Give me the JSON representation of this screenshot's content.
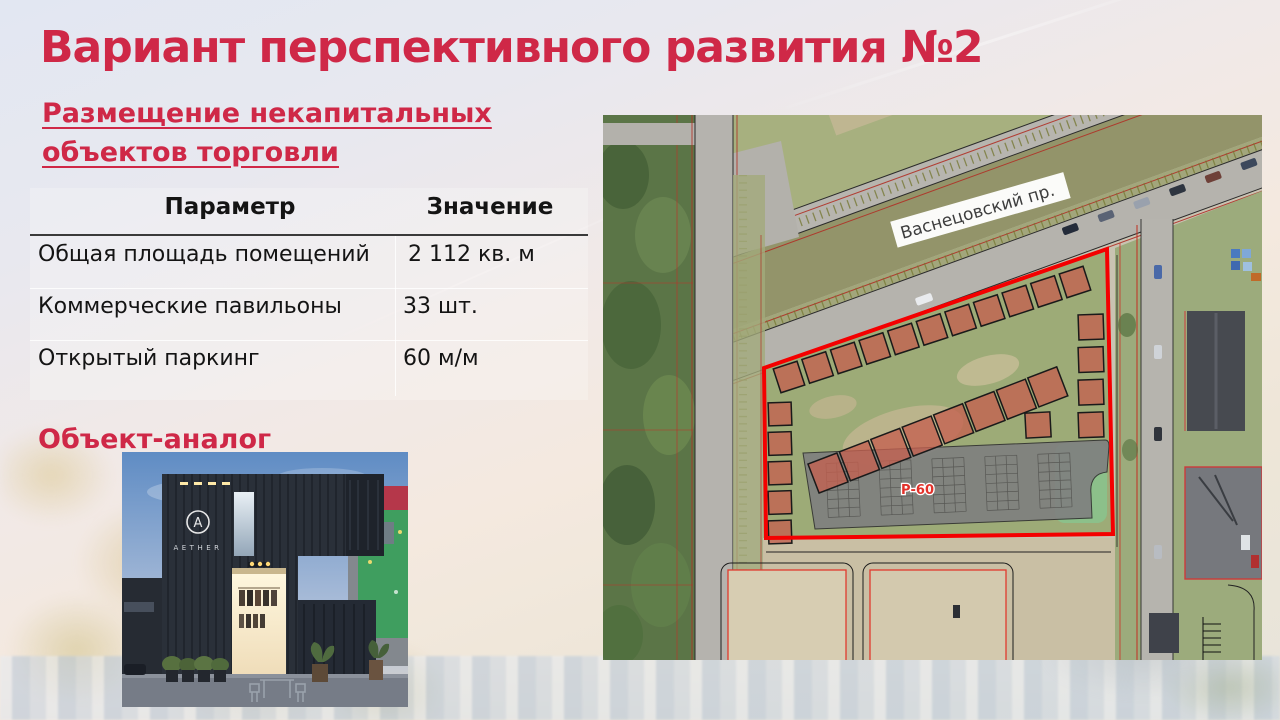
{
  "slide": {
    "title": "Вариант перспективного развития №2",
    "subtitle_line1": "Размещение некапитальных",
    "subtitle_line2": "объектов торговли",
    "analog_heading": "Объект-аналог",
    "accent_color": "#cf2847"
  },
  "table": {
    "header_param": "Параметр",
    "header_value": "Значение",
    "rows": [
      {
        "param": "Общая площадь помещений",
        "value": "2 112 кв. м"
      },
      {
        "param": "Коммерческие павильоны",
        "value": "33 шт."
      },
      {
        "param": "Открытый паркинг",
        "value": "60 м/м"
      }
    ]
  },
  "map": {
    "street_label": "Васнецовский пр.",
    "parking_label": "Р-60",
    "outline_color": "#f40000",
    "pavilion_fill": "#c4604f"
  },
  "photo": {
    "logo_letter": "A",
    "logo_text": "AETHER"
  }
}
